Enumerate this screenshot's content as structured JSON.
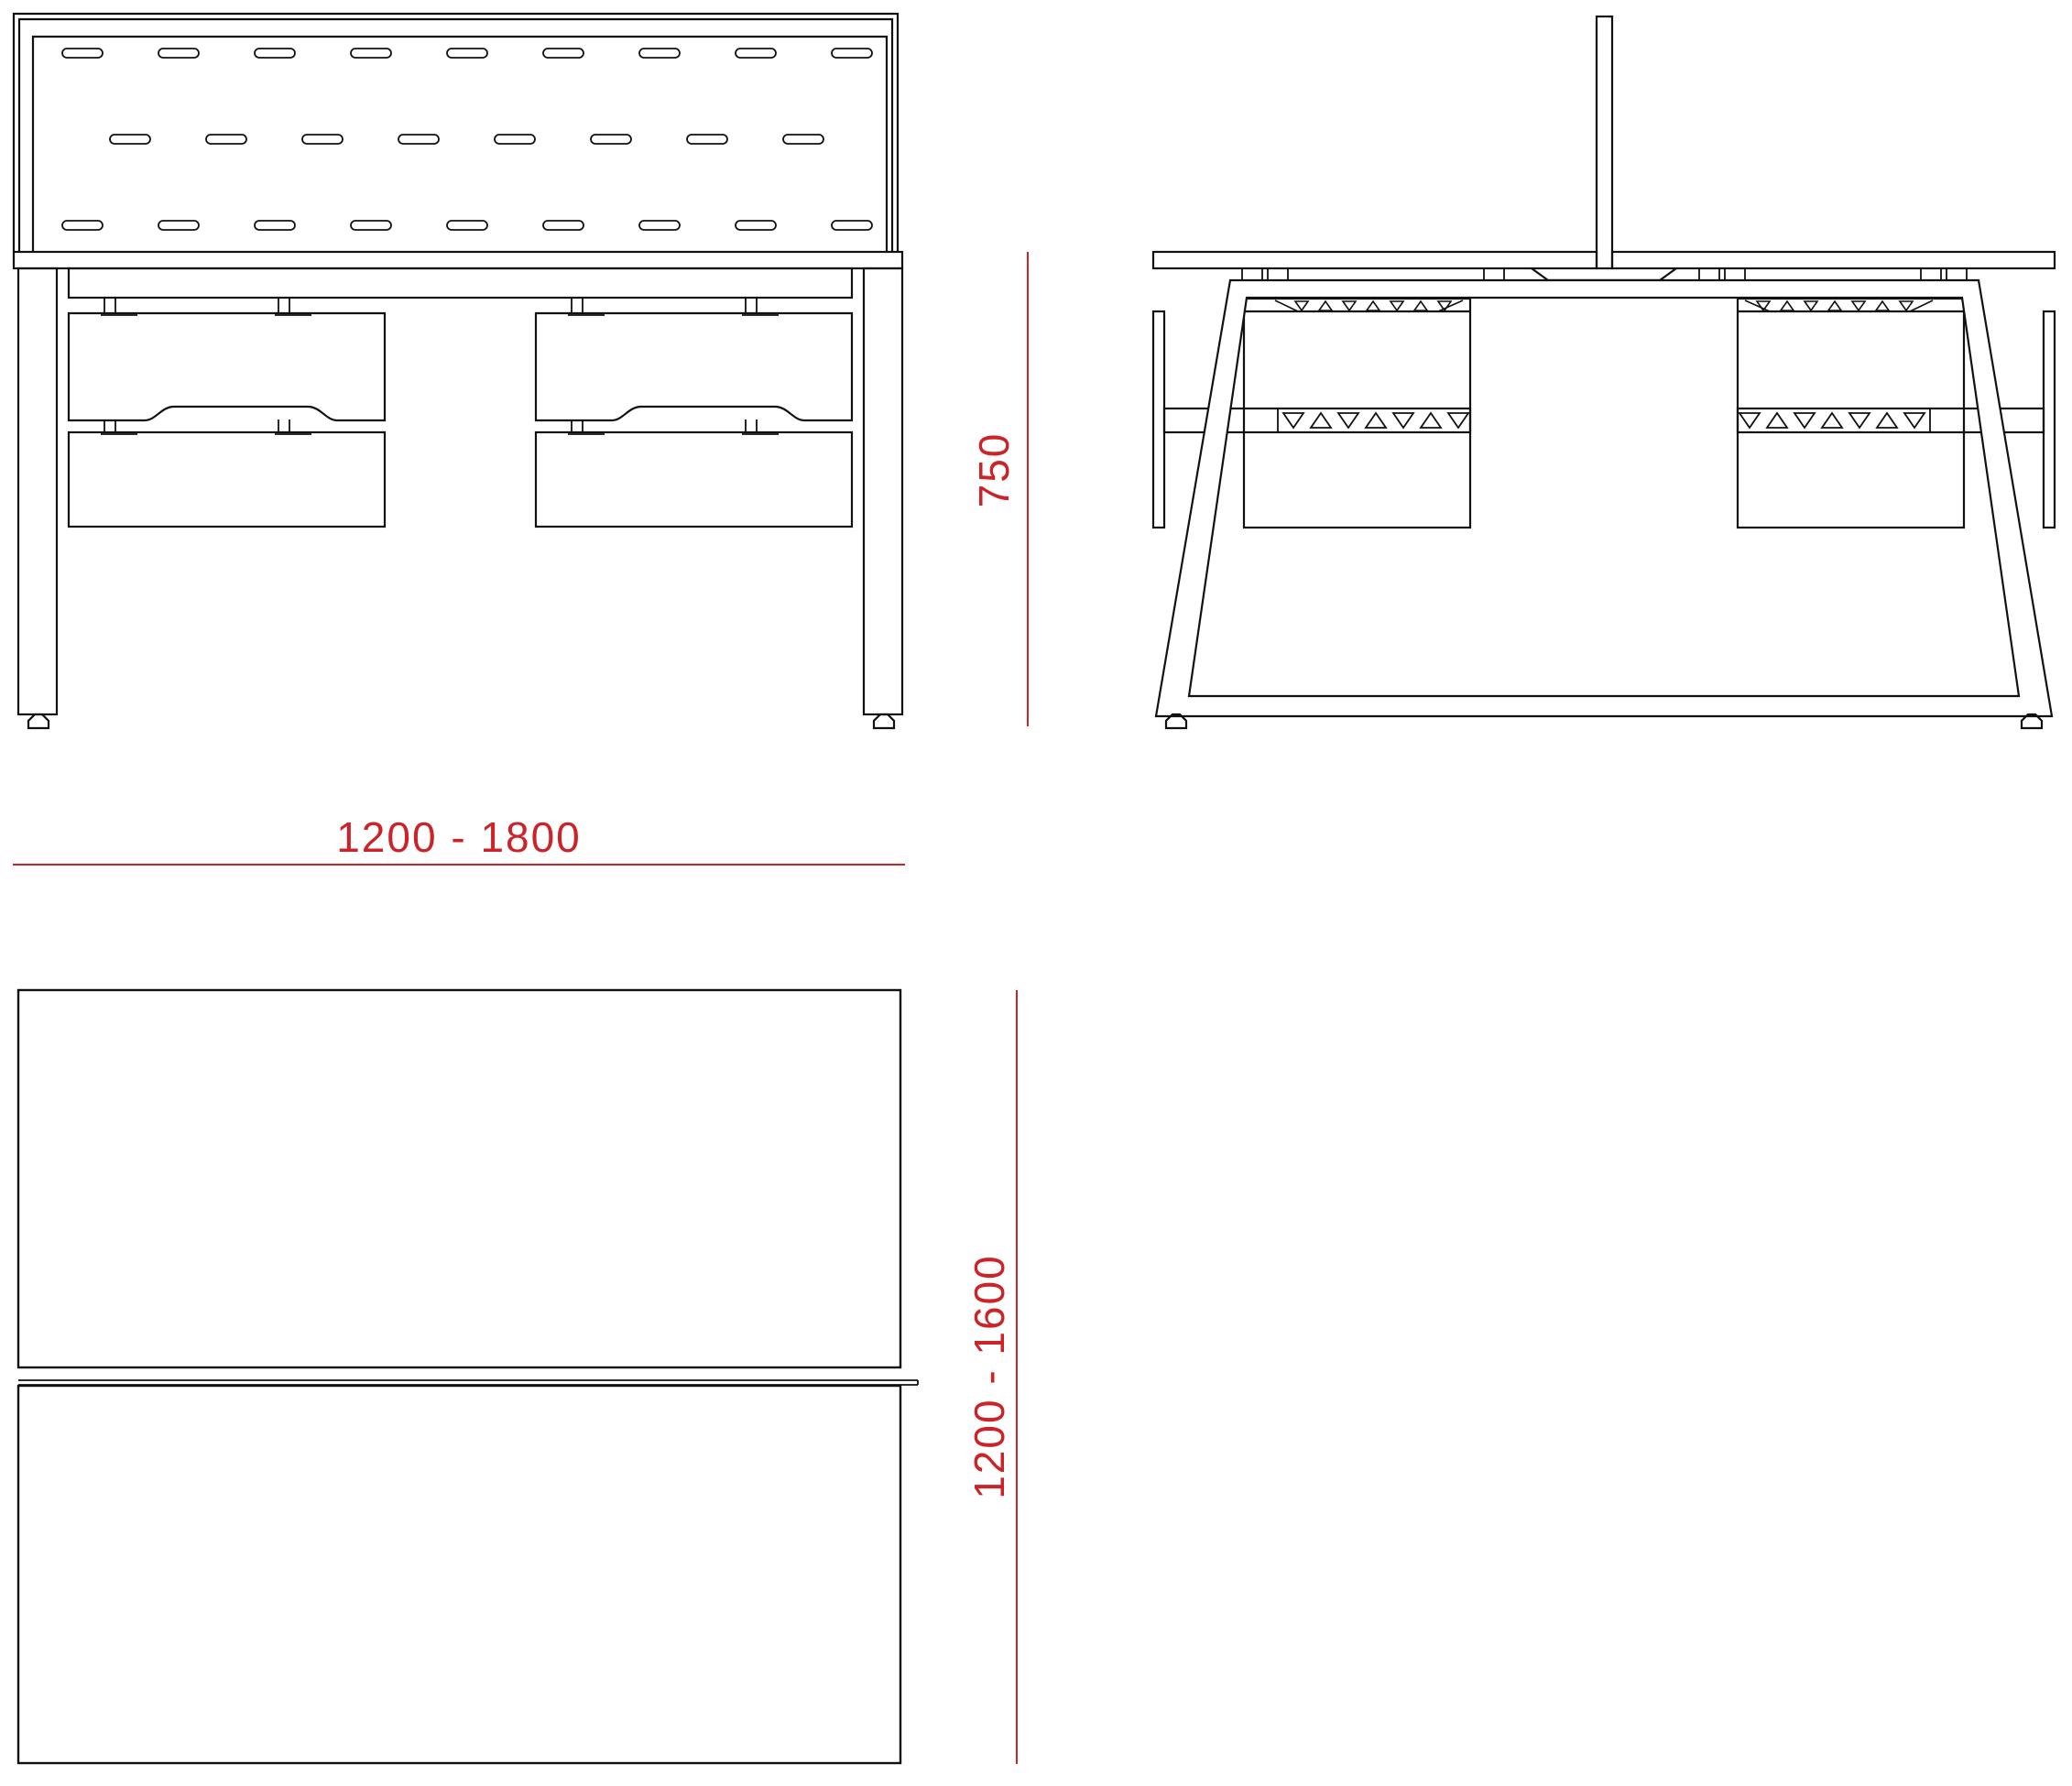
{
  "drawing": {
    "type": "technical-furniture-drawing",
    "labels": {
      "width": "1200 - 1800",
      "height": "750",
      "depth": "1200 - 1600"
    },
    "colors": {
      "dimension_red": "#CB2328",
      "line_black": "#111111",
      "background": "#ffffff"
    }
  }
}
